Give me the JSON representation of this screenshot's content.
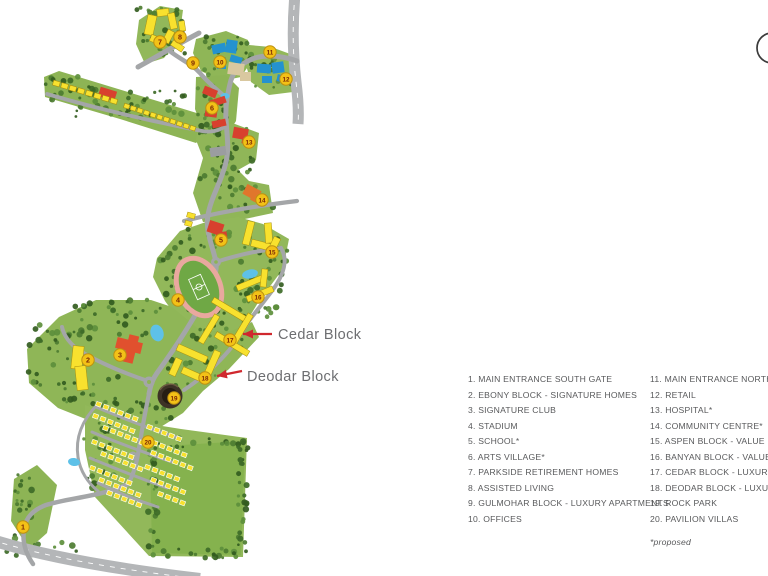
{
  "map": {
    "markers": [
      {
        "n": "1",
        "x": 23,
        "y": 527
      },
      {
        "n": "2",
        "x": 88,
        "y": 360
      },
      {
        "n": "3",
        "x": 120,
        "y": 355
      },
      {
        "n": "4",
        "x": 178,
        "y": 300
      },
      {
        "n": "5",
        "x": 221,
        "y": 240
      },
      {
        "n": "6",
        "x": 212,
        "y": 108
      },
      {
        "n": "7",
        "x": 160,
        "y": 42
      },
      {
        "n": "8",
        "x": 180,
        "y": 37
      },
      {
        "n": "9",
        "x": 193,
        "y": 63
      },
      {
        "n": "10",
        "x": 220,
        "y": 62
      },
      {
        "n": "11",
        "x": 270,
        "y": 52
      },
      {
        "n": "12",
        "x": 286,
        "y": 79
      },
      {
        "n": "13",
        "x": 249,
        "y": 142
      },
      {
        "n": "14",
        "x": 262,
        "y": 200
      },
      {
        "n": "15",
        "x": 272,
        "y": 252
      },
      {
        "n": "16",
        "x": 258,
        "y": 297
      },
      {
        "n": "17",
        "x": 230,
        "y": 340
      },
      {
        "n": "18",
        "x": 205,
        "y": 378
      },
      {
        "n": "19",
        "x": 174,
        "y": 398
      },
      {
        "n": "20",
        "x": 148,
        "y": 442
      }
    ],
    "callouts": [
      {
        "label": "Cedar Block",
        "text_x": 278,
        "text_y": 339,
        "x1": 272,
        "y1": 334,
        "x2": 243,
        "y2": 334
      },
      {
        "label": "Deodar Block",
        "text_x": 247,
        "text_y": 381,
        "x1": 242,
        "y1": 371,
        "x2": 217,
        "y2": 376
      }
    ]
  },
  "legend": {
    "column1": [
      "1. MAIN ENTRANCE SOUTH GATE",
      "2. EBONY BLOCK -  SIGNATURE HOMES",
      "3. SIGNATURE CLUB",
      "4. STADIUM",
      "5. SCHOOL*",
      "6. ARTS VILLAGE*",
      "7. PARKSIDE RETIREMENT HOMES",
      "8. ASSISTED LIVING",
      "9. GULMOHAR BLOCK - LUXURY APARTMENTS",
      "10. OFFICES"
    ],
    "column2": [
      "11. MAIN ENTRANCE NORTH GATE",
      "12. RETAIL",
      "13. HOSPITAL*",
      "14. COMMUNITY CENTRE*",
      "15. ASPEN BLOCK - VALUE PLUS HOMES",
      "16. BANYAN BLOCK - VALUE PLUS HOMES",
      "17. CEDAR BLOCK - LUXURY HOMES",
      "18. DEODAR BLOCK - LUXURY HOMES",
      "19. ROCK PARK",
      "20. PAVILION VILLAS"
    ],
    "footnote": "*proposed"
  },
  "colors": {
    "accent_red": "#d0282e",
    "marker_fill": "#f3c117",
    "marker_stroke": "#bd9110",
    "marker_text": "#7a2606",
    "callout_gray": "#6d6e71",
    "legend_gray": "#58595b"
  }
}
